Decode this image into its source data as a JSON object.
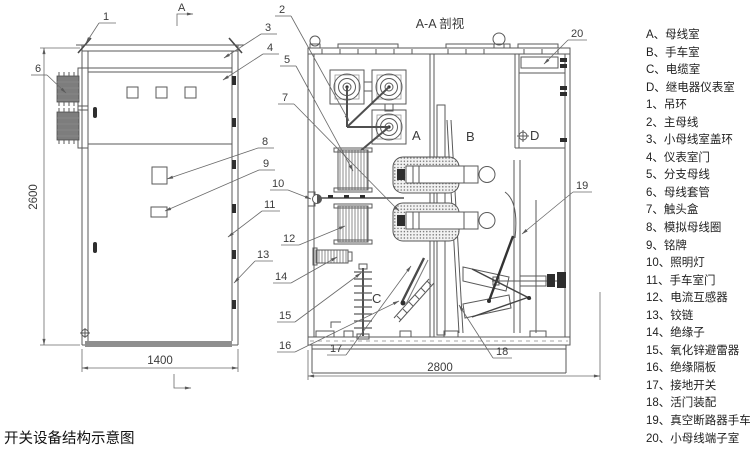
{
  "title": "开关设备结构示意图",
  "section_view_title": "A-A 剖视",
  "section_marker_label": "A",
  "dimensions": {
    "front_height": "2600",
    "front_width": "1400",
    "section_depth": "2800"
  },
  "compartment_labels": {
    "a": "A",
    "b": "B",
    "c": "C",
    "d": "D"
  },
  "callouts": {
    "n1": "1",
    "n2": "2",
    "n3": "3",
    "n4": "4",
    "n5": "5",
    "n6": "6",
    "n7": "7",
    "n8": "8",
    "n9": "9",
    "n10": "10",
    "n11": "11",
    "n12": "12",
    "n13": "13",
    "n14": "14",
    "n15": "15",
    "n16": "16",
    "n17": "17",
    "n18": "18",
    "n19": "19",
    "n20": "20"
  },
  "legend": {
    "items": [
      {
        "label": "A、母线室"
      },
      {
        "label": "B、手车室"
      },
      {
        "label": "C、电缆室"
      },
      {
        "label": "D、继电器仪表室"
      },
      {
        "label": "1、吊环"
      },
      {
        "label": "2、主母线"
      },
      {
        "label": "3、小母线室盖环"
      },
      {
        "label": "4、仪表室门"
      },
      {
        "label": "5、分支母线"
      },
      {
        "label": "6、母线套管"
      },
      {
        "label": "7、触头盒"
      },
      {
        "label": "8、模拟母线圈"
      },
      {
        "label": "9、铭牌"
      },
      {
        "label": "10、照明灯"
      },
      {
        "label": "11、手车室门"
      },
      {
        "label": "12、电流互感器"
      },
      {
        "label": "13、铰链"
      },
      {
        "label": "14、绝缘子"
      },
      {
        "label": "15、氧化锌避雷器"
      },
      {
        "label": "16、绝缘隔板"
      },
      {
        "label": "17、接地开关"
      },
      {
        "label": "18、活门装配"
      },
      {
        "label": "19、真空断路器手车"
      },
      {
        "label": "20、小母线端子室"
      }
    ]
  },
  "colors": {
    "line": "#5a5a5a",
    "text": "#3c3c3c",
    "dark_fill": "#7d7d7d",
    "base_gray": "#8f8f8f"
  }
}
